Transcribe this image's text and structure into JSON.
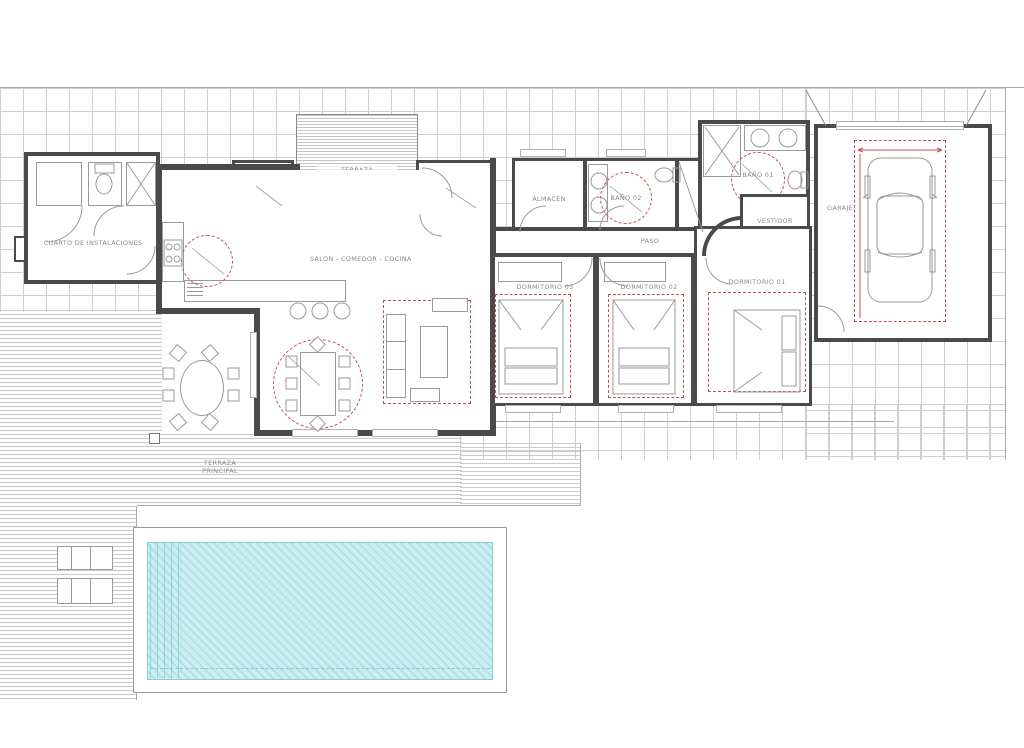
{
  "drawing": {
    "type": "residential floor plan with pool",
    "colors": {
      "wall": "#4a4a4a",
      "furniture_line": "#9a9a9a",
      "paving_grid": "#cfcfcf",
      "interior_tile": "#e2e0e0",
      "red_dashed": "#c0504d",
      "pool_water": "#cdeef0",
      "pool_hatch": "#aee2e6",
      "deck_line": "#c9c9c9",
      "label_text": "#8a8a8a"
    }
  },
  "rooms": {
    "cuarto_instalaciones": {
      "label": "CUARTO DE INSTALACIONES"
    },
    "galeria": {
      "label": "GALERIA"
    },
    "terraza_acceso": {
      "line1": "TERRAZA",
      "line2": "ACCESO"
    },
    "acceso": {
      "label": "ACCESO"
    },
    "almacen": {
      "label": "ALMACEN"
    },
    "bano02": {
      "label": "BAÑO 02"
    },
    "bano01": {
      "label": "BAÑO 01"
    },
    "vestidor": {
      "label": "VESTIDOR"
    },
    "paso": {
      "label": "PASO"
    },
    "salon": {
      "label": "SALON - COMEDOR - COCINA"
    },
    "dormitorio03": {
      "label": "DORMITORIO 03"
    },
    "dormitorio02": {
      "label": "DORMITORIO 02"
    },
    "dormitorio01": {
      "label": "DORMITORIO 01"
    },
    "garaje": {
      "label": "GARAJE"
    },
    "terraza_principal": {
      "line1": "TERRAZA",
      "line2": "PRINCIPAL"
    }
  }
}
